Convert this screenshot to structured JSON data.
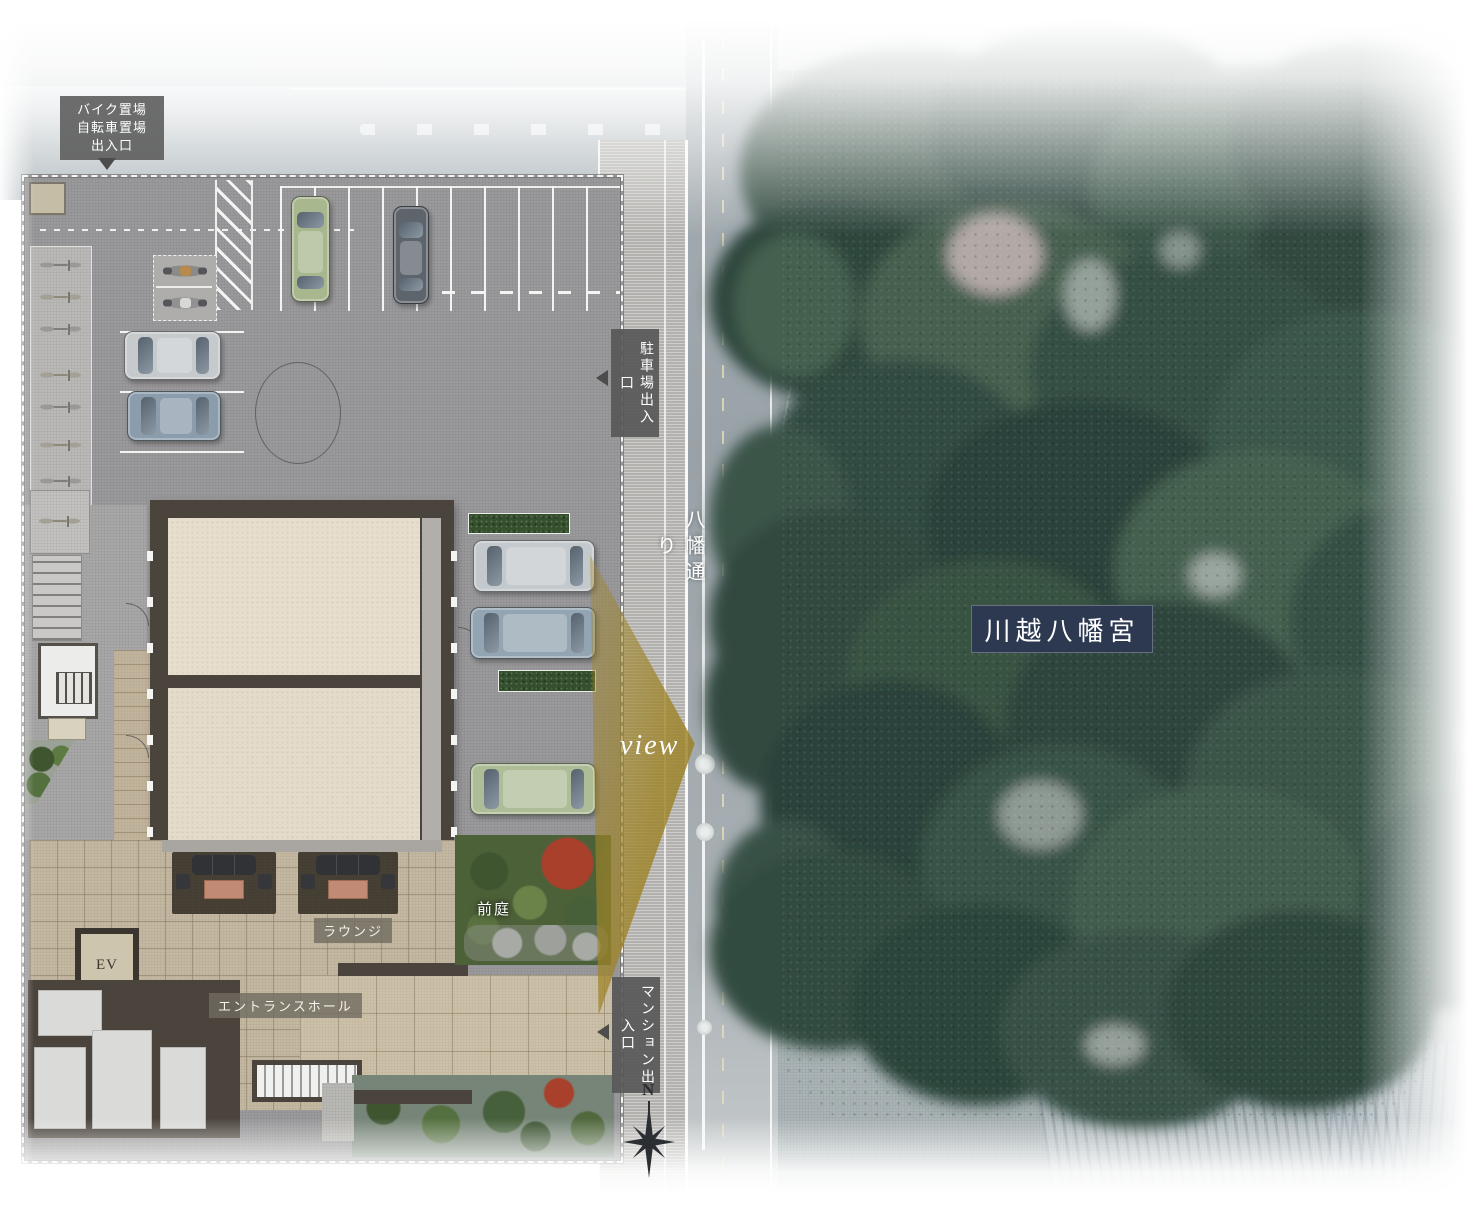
{
  "plan": {
    "labels": {
      "bike_entrance": "バイク置場\n自転車置場\n出入口",
      "parking_exit": "駐車場出入口",
      "mansion_entrance": "マンション出入口",
      "lounge": "ラウンジ",
      "entrance_hall": "エントランスホール",
      "elevator": "EV",
      "front_garden": "前庭"
    }
  },
  "street": {
    "name": "八幡通り"
  },
  "view": {
    "label": "view"
  },
  "shrine": {
    "name": "川越八幡宮"
  },
  "compass": {
    "north": "N"
  },
  "colors": {
    "view_cone_gold": "#9e8530",
    "shrine_box_navy": "#2c3951",
    "forest_green": "#355044",
    "building_wall": "#4b443c",
    "room_beige": "#e6ddcc",
    "lobby_tile": "#c4b8a1",
    "asphalt_gray": "#9a999b",
    "road_gray": "#9fa8ad",
    "garden_green": "#4f6538",
    "maple_red": "#a8402c",
    "label_box_gray": "#5d5d5d"
  }
}
